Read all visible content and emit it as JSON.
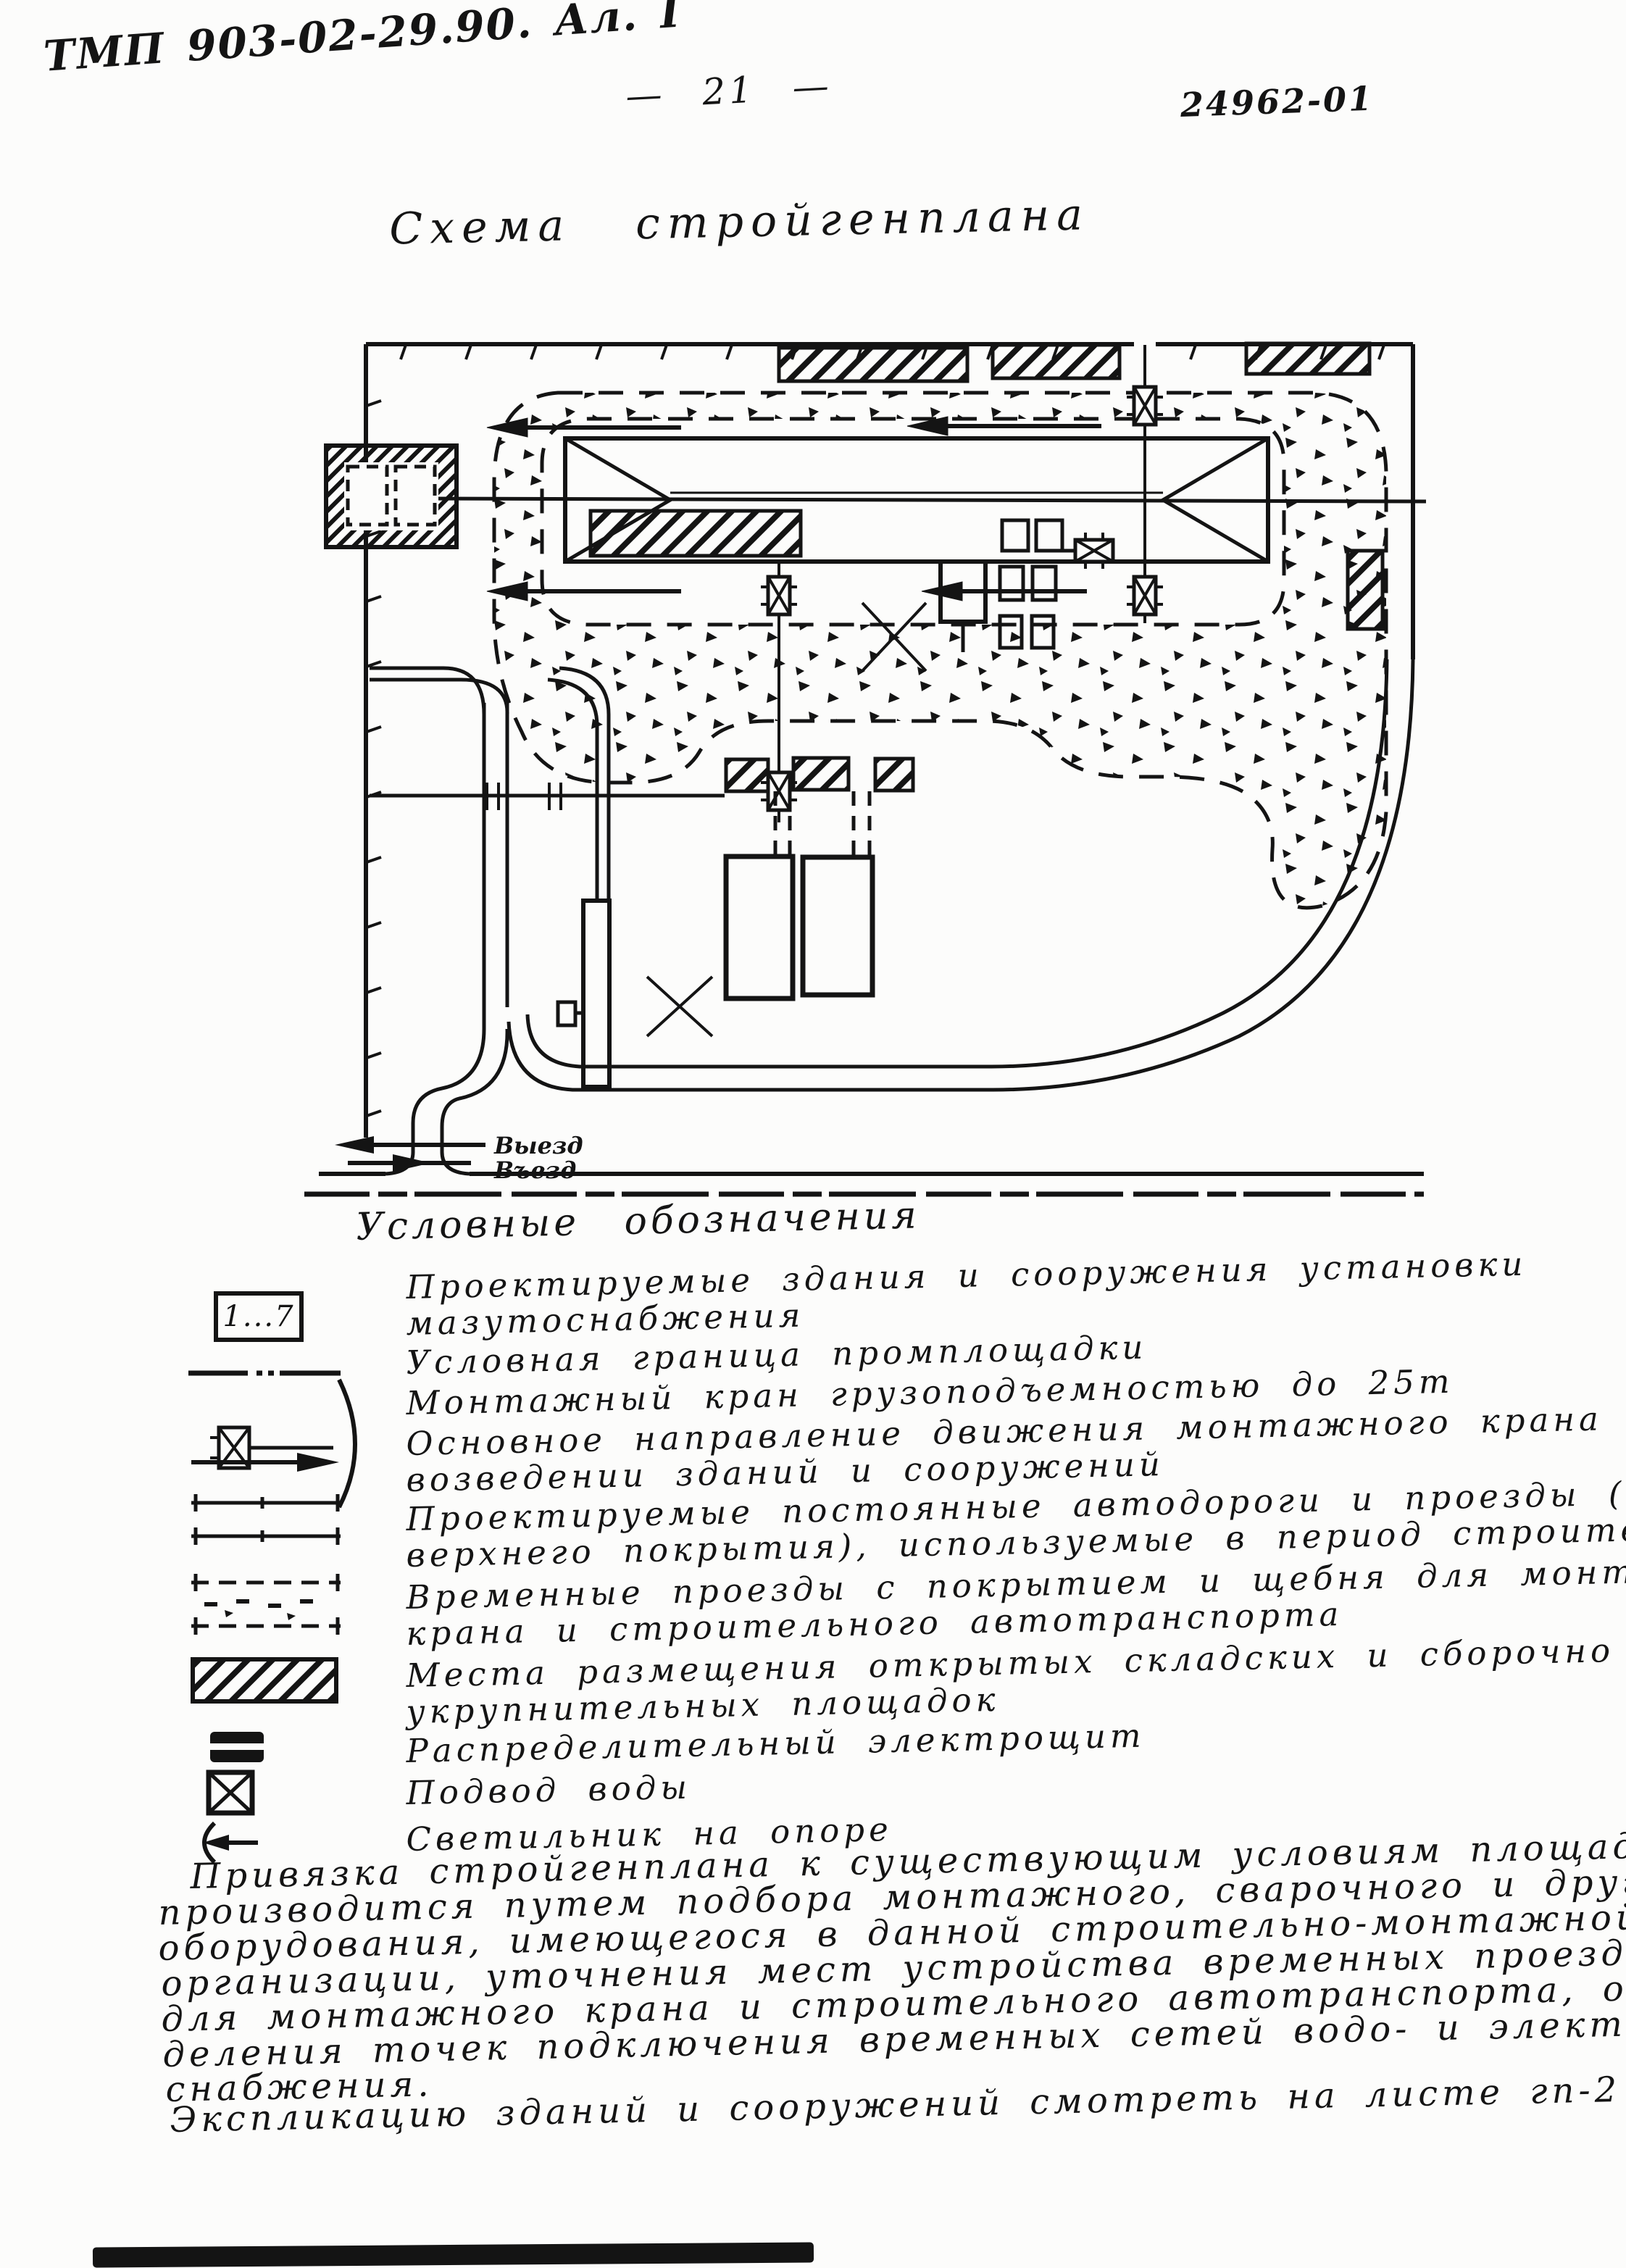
{
  "header": {
    "doc_code": "ТМП 903-02-29.90. Ал. I",
    "page_number": "— 21 —",
    "doc_number": "24962-01"
  },
  "title": "Схема стройгенплана",
  "diagram": {
    "exit_label": "Выезд",
    "entry_label": "Въезд"
  },
  "legend": {
    "heading": "Условные обозначения",
    "items": [
      {
        "symbol": "numbered-buildings-box",
        "symbol_label": "1...7",
        "lines": [
          "Проектируемые здания и сооружения установки",
          "мазутоснабжения"
        ]
      },
      {
        "symbol": "site-boundary-dashdot-line",
        "lines": [
          "Условная граница промплощадки"
        ]
      },
      {
        "symbol": "mounting-crane",
        "lines": [
          "Монтажный кран грузоподъемностью до 25т"
        ]
      },
      {
        "symbol": "crane-direction-arrow",
        "lines": [
          "Основное направление движения монтажного крана при",
          "возведении зданий и сооружений"
        ]
      },
      {
        "symbol": "permanent-road",
        "lines": [
          "Проектируемые постоянные автодороги и проезды ( без",
          "верхнего покрытия), используемые в период строительства"
        ]
      },
      {
        "symbol": "temporary-road",
        "lines": [
          "Временные проезды с покрытием и щебня для монтажного",
          "крана и строительного автотранспорта"
        ]
      },
      {
        "symbol": "open-storage-hatch",
        "lines": [
          "Места размещения открытых складских и сборочно —",
          "укрупнительных площадок"
        ]
      },
      {
        "symbol": "distribution-board",
        "lines": [
          "Распределительный электрощит"
        ]
      },
      {
        "symbol": "water-supply",
        "lines": [
          "Подвод воды"
        ]
      },
      {
        "symbol": "light-on-pole",
        "lines": [
          "Светильник на опоре"
        ]
      }
    ]
  },
  "paragraph": {
    "lines": [
      "Привязка стройгенплана к существующим условиям площадки",
      "производится путем подбора монтажного, сварочного и другого",
      "оборудования, имеющегося в данной строительно-монтажной",
      "организации, уточнения мест устройства временных проездов",
      "для монтажного крана и строительного автотранспорта, опре-",
      "деления точек подключения временных сетей водо- и электро-",
      "снабжения.",
      "Экспликацию зданий и сооружений смотреть на листе гп-2"
    ]
  }
}
